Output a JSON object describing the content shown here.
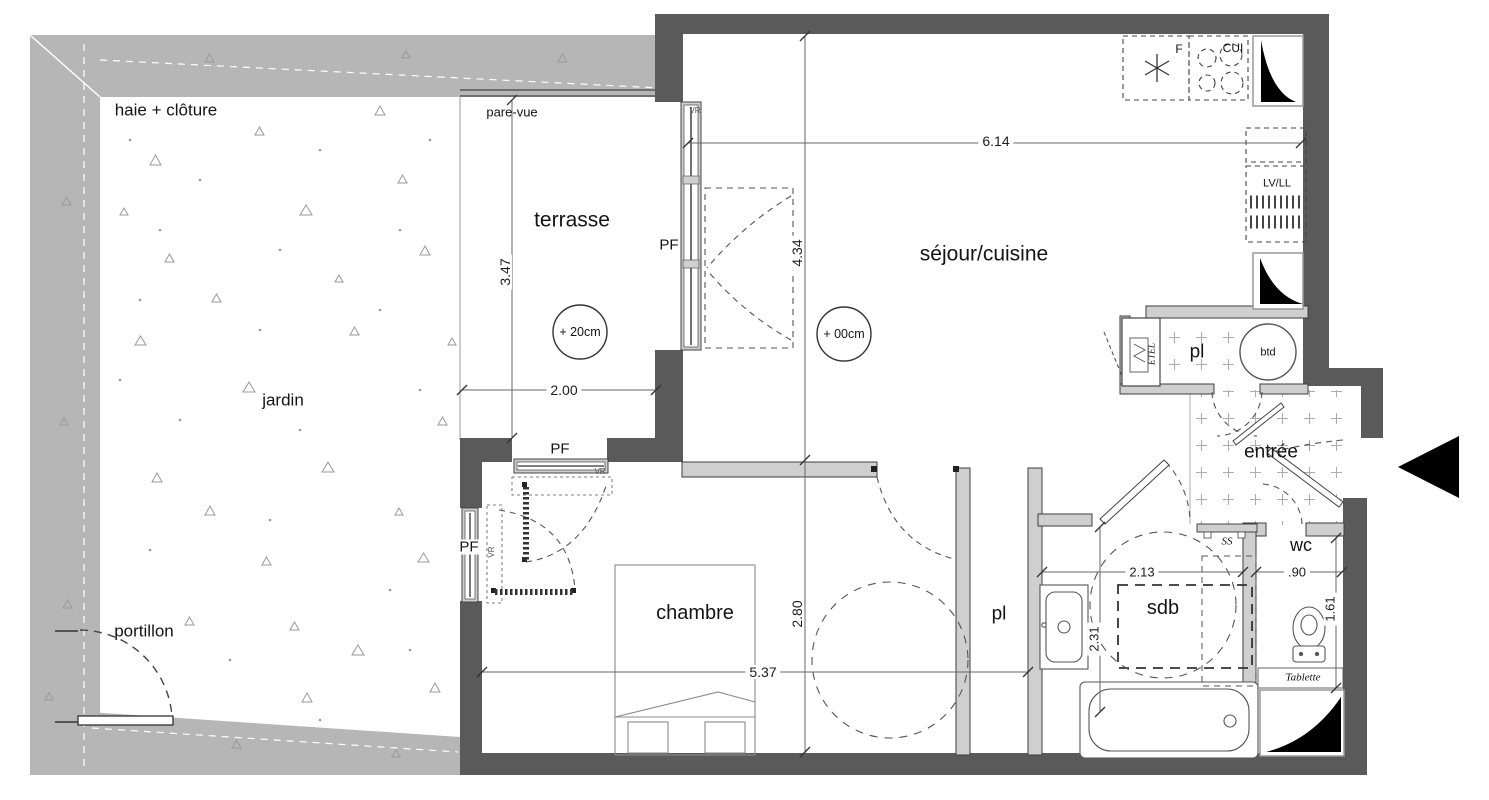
{
  "garden": {
    "hedge_label": "haie + clôture",
    "area_label": "jardin",
    "gate_label": "portillon",
    "screen_label": "pare-vue"
  },
  "rooms": {
    "terrasse": {
      "label": "terrasse",
      "level": "+ 20cm",
      "width": "2.00",
      "depth": "3.47"
    },
    "sejour": {
      "label": "séjour/cuisine",
      "level": "+ 00cm",
      "width": "6.14",
      "depth": "4.34"
    },
    "chambre": {
      "label": "chambre",
      "width": "5.37",
      "depth": "2.80"
    },
    "sdb": {
      "label": "sdb",
      "width": "2.13",
      "depth": "2.31"
    },
    "wc": {
      "label": "wc",
      "width": ".90",
      "depth": "1.61"
    },
    "entree": {
      "label": "entrée"
    },
    "closet_entry": {
      "label": "pl"
    },
    "closet_hall": {
      "label": "pl"
    }
  },
  "fixtures": {
    "fridge": "F",
    "cooktop": "CUI",
    "laundry": "LV/LL",
    "water_heater": "btd",
    "etel": "ETEL",
    "towel_dryer": "SS",
    "shelf": "Tablette"
  },
  "openings": {
    "window_door_label": "PF",
    "shutter_label": "VR"
  },
  "colors": {
    "exterior_wall": "#5a5a5a",
    "partition": "#cfcfcf",
    "hedge": "#b6b6b6",
    "tile_mark": "#adadad",
    "black": "#000000"
  }
}
